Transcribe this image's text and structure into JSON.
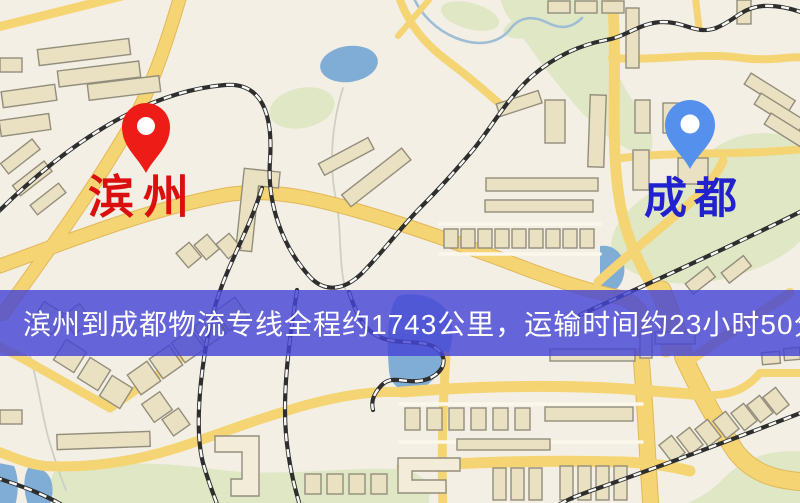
{
  "banner": {
    "text": "滨州到成都物流专线全程约1743公里，运输时间约23小时50分钟."
  },
  "markers": {
    "origin": {
      "label": "滨州"
    },
    "destination": {
      "label": "成都"
    }
  },
  "palette": {
    "background": "#f3efe5",
    "road": "#f5d474",
    "road_casing": "#e2b858",
    "road_thin": "#fbf7ea",
    "building": "#eae1c2",
    "building_light": "#f2ecd8",
    "building_outline": "#938d7c",
    "railway": "#2e2e2e",
    "railway_dash": "#f8f8f4",
    "water": "#7fadd6",
    "river": "#9fbdd4",
    "stream": "#cfcfc2",
    "park": "#dfe7c5",
    "banner_bg": "rgba(70,70,214,0.82)",
    "banner_text": "#ffffff",
    "origin_pin": "#ed1c16",
    "origin_label": "#dc0f0f",
    "destination_pin": "#5590ec",
    "destination_label": "#2121cd",
    "pin_hole": "#ffffff"
  }
}
